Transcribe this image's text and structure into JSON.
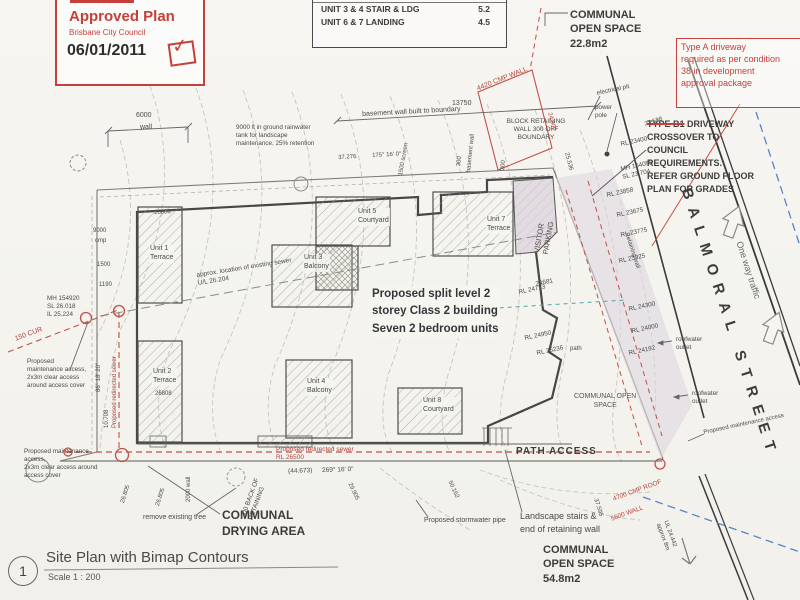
{
  "stamp": {
    "title": "Approved Plan",
    "org": "Brisbane City Council",
    "date": "06/01/2011"
  },
  "icons": {
    "approved_check": "✓"
  },
  "table": {
    "r1_label": "UNIT 3 & 4 STAIR & LDG",
    "r1_value": "5.2",
    "r2_label": "UNIT 6 & 7 LANDING",
    "r2_value": "4.5"
  },
  "boxes": {
    "type_a": "Type A driveway\nrequired as per condition\n38 in development\napproval package",
    "b1_struck": "TYPE B1",
    "b1_rest": " DRIVEWAY\nCROSSOVER TO\nCOUNCIL\nREQUIREMENTS.\nREFER GROUND FLOOR\nPLAN FOR GRADES"
  },
  "street": {
    "name": "BALMORAL STREET",
    "one_way": "One way traffic"
  },
  "building": {
    "note": "Proposed split level 2\nstorey Class 2  building\nSeven 2 bedroom units",
    "u1": "Unit 1\nTerrace",
    "u2": "Unit 2\nTerrace",
    "u3": "Unit 3\nBalcony",
    "u4": "Unit 4\nBalcony",
    "u5": "Unit 5\nCourtyard",
    "u7": "Unit 7\nTerrace",
    "u8": "Unit 8\nCourtyard",
    "visitor": "VISITOR\nPARKING"
  },
  "spaces": {
    "top": "COMMUNAL\nOPEN SPACE\n22.8m2",
    "mid": "COMMUNAL OPEN\nSPACE",
    "bottom": "COMMUNAL\nOPEN SPACE\n54.8m2",
    "drying": "COMMUNAL\nDRYING AREA",
    "path": "PATH ACCESS"
  },
  "title_block": {
    "num": "1",
    "title": "Site Plan with Bimap Contours",
    "scale": "Scale   1 : 200"
  },
  "labels": {
    "dim13750": "13750",
    "basement": "basement wall built to boundary",
    "bdy37276": "37.276",
    "ang175": "175° 16' 0\"",
    "screen": "1500  screen",
    "bwall": "basement wall",
    "t300a": "300",
    "t300b": "300",
    "block_ret": "BLOCK RETAINING\nWALL 300 OFF\nBOUNDARY",
    "cmp_wall": "4420 CMP WALL",
    "elec": "electrical pit",
    "pole": "power\npole",
    "v23588": "23.588",
    "rl23400": "RL 23400",
    "mh_b": "MH 154055\nSL 23.704",
    "rl23858": "RL 23858",
    "rl23675": "RL 23675",
    "rl23775": "RL 23775",
    "rl23925": "RL 23925",
    "v24000": "24.000",
    "v25536": "25.536",
    "ret_wall": "Retaining wall",
    "rl24300": "RL 24300",
    "rl24000": "RL 24000",
    "rl24192": "RL 24192",
    "n24681": "24681",
    "rl24713": "RL 24713",
    "rl24950": "RL 24950",
    "rl25236": "RL 25236",
    "path_s": "path",
    "roof1": "roofwater\noutlet",
    "roof2": "roofwater\noutlet",
    "maint_r": "Proposed maintenance access",
    "dim6000": "6000",
    "wall_s": "wall",
    "tank": "9000 lt in ground rainwater\ntank for landscape\nmaintenance, 25% retention",
    "d26808a": "26808",
    "d26808b": "26808",
    "sewer_ex": "approx. location of existing sewer\nU/L 26.204",
    "mh_a": "MH 154920\nSL 26.018\nIL 25.224",
    "cur150": "150 CUR",
    "maint1": "Proposed\nmaintenance access,\n2x3m clear access\naround access cover",
    "maint2": "Proposed maintenance\naccess,\n2x3m clear access around\naccess cover",
    "l9000": "9000",
    "lcmp": "cmp",
    "l1500": "1500",
    "l1190": "1190",
    "angle_l": "86° 18' 20\"",
    "d10708": "10.708",
    "sewer_v": "Proposed redirected sewer",
    "back_ret": "300 BACK OF\nRETAINING",
    "rm_tree": "remove existing tree",
    "w2000": "2000 wall",
    "sp1": "26.805",
    "sp2": "26.805",
    "d44673": "(44.673)",
    "ang269": "269° 16' 0\"",
    "d29905": "29.905",
    "d50162": "50.162",
    "sewer_b": "Proposed redirected sewer\nRL 26500",
    "storm": "Proposed stormwater pipe",
    "stairs": "Landscape stairs &\nend of retaining wall",
    "cmp_roof": "4700 CMP ROOF",
    "wall5600": "5600 WALL",
    "d37595": "37.595",
    "ul24442": "UL 24.442\napprox 8m"
  }
}
